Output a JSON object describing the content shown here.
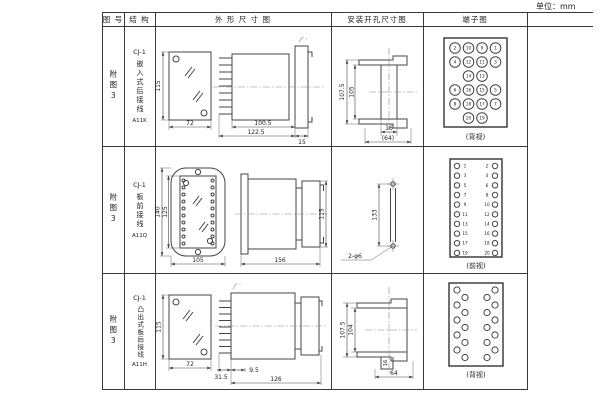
{
  "unit_label": "单位：mm",
  "header": {
    "fig": "图 号",
    "struct": "结 构",
    "outline": "外 形 尺 寸 图",
    "mount": "安装开孔尺寸图",
    "terminal": "端子图"
  },
  "rows": [
    {
      "fig_no": "附图3",
      "structure": {
        "model": "CJ-1",
        "desc": "嵌入式后接线",
        "code": "A11K"
      },
      "outline": {
        "front_h": "115",
        "front_w": "72",
        "body_len": "100.5",
        "overall_len": "122.5",
        "flange_d": "15"
      },
      "mount": {
        "outer_h": "107.5",
        "inner_h": "105",
        "slot_w": "16",
        "overall_w": "(64)"
      },
      "terminal": {
        "view": "(背视)",
        "numbers": [
          2,
          10,
          9,
          1,
          4,
          12,
          11,
          3,
          14,
          13,
          6,
          16,
          15,
          5,
          8,
          18,
          17,
          7,
          20,
          19
        ]
      }
    },
    {
      "fig_no": "附图3",
      "structure": {
        "model": "CJ-1",
        "desc": "板前接线",
        "code": "A11Q"
      },
      "outline": {
        "outer_h": "140",
        "inner_h": "125",
        "front_w": "105",
        "body_len": "156",
        "side_h": "115"
      },
      "mount": {
        "hole_pitch": "133",
        "hole_label": "2-φ6"
      },
      "terminal": {
        "view": "(前视)",
        "left": [
          1,
          3,
          5,
          7,
          9,
          11,
          13,
          15,
          17,
          19
        ],
        "right": [
          2,
          4,
          6,
          8,
          10,
          12,
          14,
          16,
          18,
          20
        ]
      }
    },
    {
      "fig_no": "附图3",
      "structure": {
        "model": "CJ-1",
        "desc": "凸出式板后接线",
        "code": "A11H"
      },
      "outline": {
        "front_h": "115",
        "front_w": "72",
        "pin_len": "31.5",
        "offset": "9.5",
        "body_len": "126"
      },
      "mount": {
        "outer_h": "107.5",
        "inner_h": "104",
        "slot_w": "16",
        "overall_w": "64"
      },
      "terminal": {
        "view": "(背视)"
      }
    }
  ]
}
